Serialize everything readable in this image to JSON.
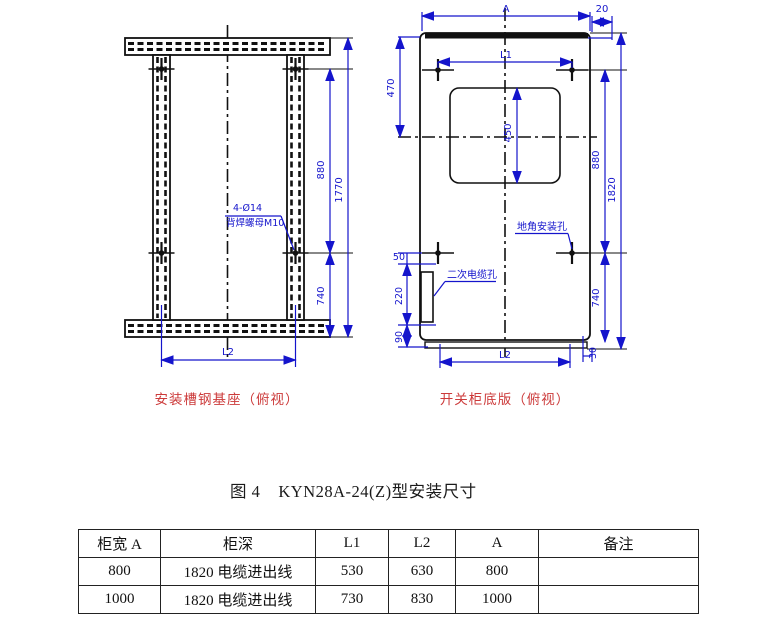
{
  "colors": {
    "dim_blue": "#1414cc",
    "line_black": "#111111",
    "caption_red": "#cc3a3a"
  },
  "left": {
    "caption": "安装槽钢基座（俯视）",
    "dim_880": "880",
    "dim_1770": "1770",
    "dim_740": "740",
    "dim_l2": "L2",
    "note_line1": "4-Ø14",
    "note_line2": "背焊螺母M10"
  },
  "right": {
    "caption": "开关柜底版（俯视）",
    "dim_a": "A",
    "dim_20": "20",
    "dim_l1": "L1",
    "dim_450": "450",
    "dim_470": "470",
    "dim_50": "50",
    "dim_220": "220",
    "dim_90": "90",
    "dim_880": "880",
    "dim_1820": "1820",
    "dim_740": "740",
    "dim_30": "30",
    "dim_l2": "L2",
    "label_anchor_hole": "地角安装孔",
    "label_cable_hole": "二次电缆孔"
  },
  "caption": {
    "fig_no": "图 4",
    "title": "KYN28A-24(Z)型安装尺寸"
  },
  "table": {
    "headers": [
      "柜宽 A",
      "柜深",
      "L1",
      "L2",
      "A",
      "备注"
    ],
    "rows": [
      [
        "800",
        "1820 电缆进出线",
        "530",
        "630",
        "800",
        ""
      ],
      [
        "1000",
        "1820 电缆进出线",
        "730",
        "830",
        "1000",
        ""
      ]
    ]
  }
}
